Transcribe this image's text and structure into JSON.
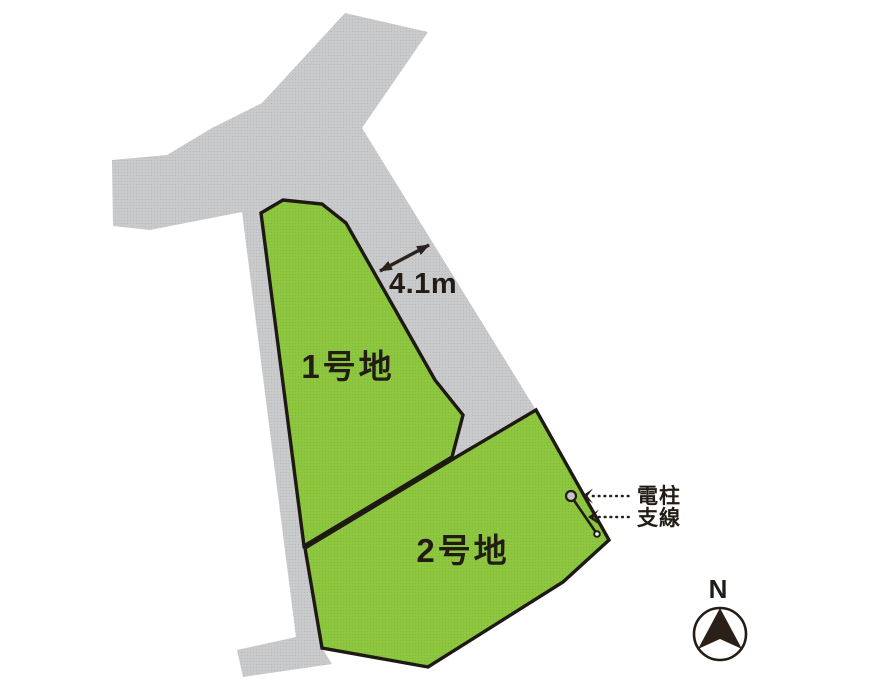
{
  "diagram": {
    "lots": [
      {
        "id": "lot-1",
        "label": "1号地"
      },
      {
        "id": "lot-2",
        "label": "2号地"
      }
    ],
    "dimension": {
      "label": "4.1m"
    },
    "annotations": {
      "pole_label": "電柱",
      "wire_label": "支線"
    },
    "compass": {
      "label": "N"
    },
    "colors": {
      "road": "#c9cacb",
      "lot_green": "#8dc63f",
      "line_black": "#221c15",
      "pole_fill": "#c4c4c4"
    }
  }
}
